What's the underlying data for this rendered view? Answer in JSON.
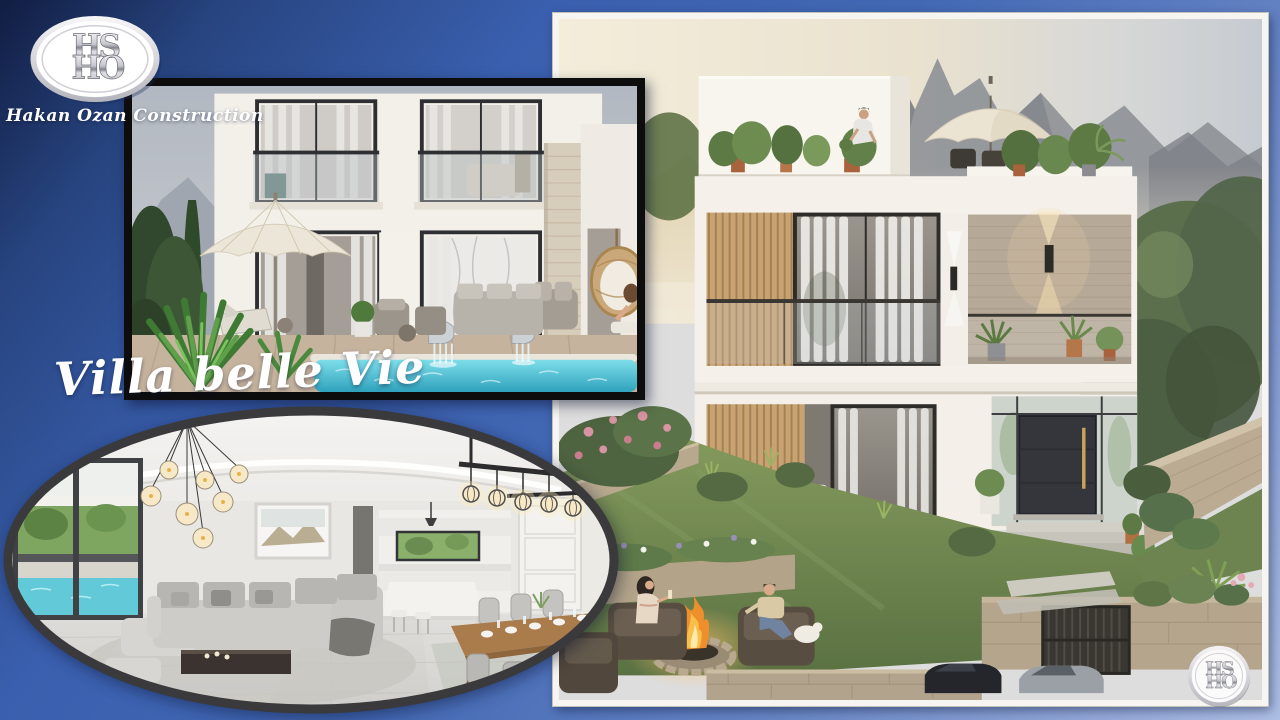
{
  "brand": {
    "monogram_top": "HS",
    "monogram_bottom": "HO",
    "company_name": "Hakan Ozan Construction"
  },
  "title": "Villa belle Vie",
  "photos": {
    "pool_villa": {
      "alt": "White duplex villa with black-framed balconies, cream patio umbrella, lounge furniture, hanging egg chair and turquoise pool with steel waterfall cascades"
    },
    "main_villa": {
      "alt": "Modern white villa with wood slat screens, stone feature wall, rooftop terrace with plants and umbrella, mountain backdrop, garden fire pit with a couple seated around it, stone walls, gate and parked cars"
    },
    "interior": {
      "alt": "Open-plan living and dining room with grey sectional sofa, glass globe chandelier, caged-bulb dining chandelier, wooden dining table set for eight, white kitchen island and a window with pool view"
    }
  },
  "colors": {
    "background_top": "#111d42",
    "background_mid": "#3d63af",
    "background_bottom": "#aebfe5",
    "black_frame": "#0d0d0d",
    "white_frame": "#f6f5f1",
    "oval_ring": "#3a3a3d",
    "pool_water": "#55c3d6",
    "title_text": "#ffffff"
  }
}
